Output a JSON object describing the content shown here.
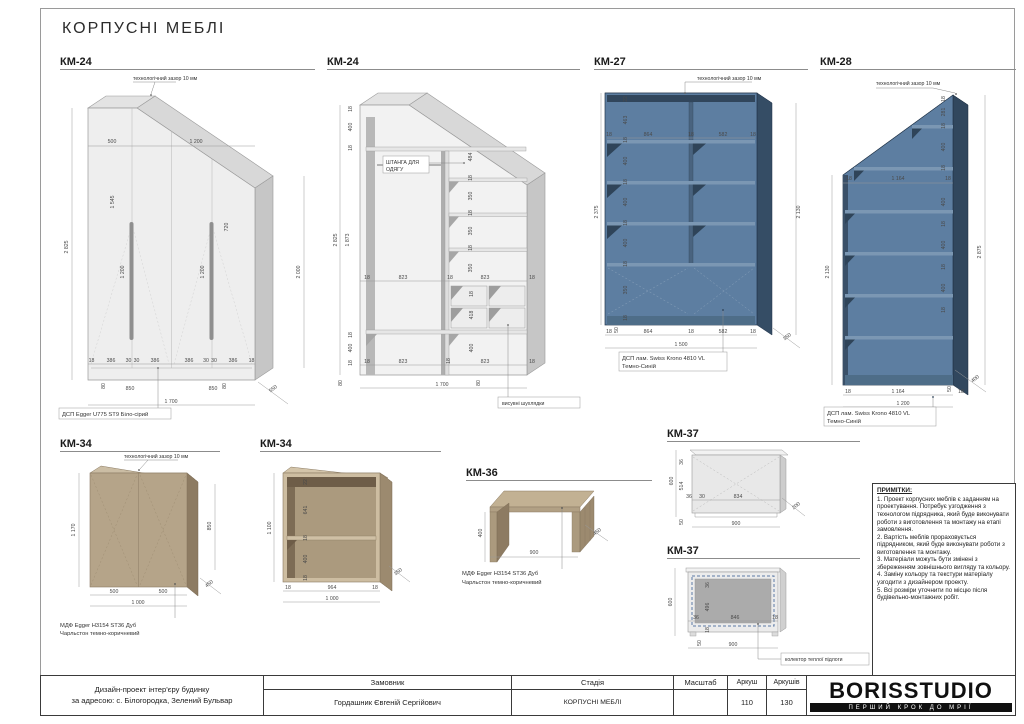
{
  "sheet": {
    "title": "КОРПУСНІ МЕБЛІ"
  },
  "drawings": {
    "km24a": {
      "code": "КМ-24",
      "leader_gap": "технологічний зазор 10 мм",
      "material": "ДСП Egger U775 ST9 Біло-сірий",
      "dims": [
        "500",
        "1 200",
        "1 545",
        "720",
        "2 825",
        "2 000",
        "1 200",
        "1 200",
        "18",
        "386",
        "30",
        "30",
        "386",
        "386",
        "30",
        "30",
        "386",
        "18",
        "80",
        "850",
        "850",
        "80",
        "1 700",
        "550"
      ]
    },
    "km24b": {
      "code": "КМ-24",
      "leader_rod_1": "ШТАНГА ДЛЯ",
      "leader_rod_2": "ОДЯГУ",
      "leader_drawers": "висувні шухлядки",
      "dims": [
        "18",
        "400",
        "18",
        "2 825",
        "1 873",
        "484",
        "18",
        "350",
        "18",
        "350",
        "18",
        "350",
        "18",
        "823",
        "18",
        "823",
        "18",
        "18",
        "418",
        "400",
        "18",
        "823",
        "18",
        "823",
        "18",
        "18",
        "400",
        "18",
        "80",
        "1 700",
        "80"
      ]
    },
    "km27": {
      "code": "КМ-27",
      "leader_gap": "технологічний зазор 10 мм",
      "material_1": "ДСП лам. Swiss Krono 4810 VL",
      "material_2": "Темно-Синій",
      "dims": [
        "2 375",
        "22",
        "463",
        "18",
        "400",
        "18",
        "400",
        "18",
        "400",
        "18",
        "350",
        "18",
        "2 130",
        "18",
        "864",
        "18",
        "582",
        "18",
        "18",
        "50",
        "864",
        "18",
        "582",
        "18",
        "1 500",
        "350"
      ]
    },
    "km28": {
      "code": "КМ-28",
      "leader_gap": "технологічний зазор 10 мм",
      "material_1": "ДСП лам. Swiss Krono 4810 VL",
      "material_2": "Темно-Синій",
      "dims": [
        "18",
        "281",
        "18",
        "400",
        "18",
        "18",
        "1 164",
        "18",
        "400",
        "18",
        "400",
        "18",
        "400",
        "18",
        "2 130",
        "2 875",
        "18",
        "1 164",
        "50",
        "18",
        "1 200",
        "400"
      ]
    },
    "km34a": {
      "code": "КМ-34",
      "leader_gap": "технологічний зазор 10 мм",
      "material_1": "МДФ Egger H3154 ST36 Дуб",
      "material_2": "Чарльстон темно-коричневий",
      "dims": [
        "1 170",
        "850",
        "450",
        "500",
        "500",
        "1 000"
      ]
    },
    "km34b": {
      "code": "КМ-34",
      "dims": [
        "1 100",
        "22",
        "641",
        "18",
        "400",
        "18",
        "18",
        "964",
        "18",
        "1 000",
        "350"
      ]
    },
    "km36": {
      "code": "КМ-36",
      "material_1": "МДФ Egger H3154 ST36 Дуб",
      "material_2": "Чарльстон темно-коричневий",
      "dims": [
        "400",
        "900",
        "450"
      ]
    },
    "km37a": {
      "code": "КМ-37",
      "dims": [
        "600",
        "36",
        "514",
        "50",
        "36",
        "30",
        "834",
        "900",
        "200"
      ]
    },
    "km37b": {
      "code": "КМ-37",
      "leader_collector": "колектор теплої підлоги",
      "dims": [
        "600",
        "36",
        "496",
        "36",
        "846",
        "18",
        "18",
        "50",
        "900"
      ]
    }
  },
  "notes": {
    "heading": "ПРИМІТКИ:",
    "items": [
      "1. Проект корпусних меблів є заданням на проектування. Потребує узгодження з технологом підрядника, який буде виконувати роботи з виготовлення та монтажу на етапі замовлення.",
      "2. Вартість меблів прораховується підрядником, який буде виконувати роботи з виготовлення та монтажу.",
      "3. Матеріали можуть бути змінені з збереженням зовнішнього вигляду та кольору.",
      "4. Заміну кольору та текстури матеріалу узгодити з дизайнером проекту.",
      "5. Всі розміри уточнити по місцю після будівельно-монтажних робіт."
    ]
  },
  "titleblock": {
    "project_line1": "Дизайн-проект інтер'єру будинку",
    "project_line2": "за адресою: с. Білогородка, Зелений Бульвар",
    "customer_label": "Замовник",
    "customer_name": "Гордашник Євгеній Сергійович",
    "stage_label": "Стадія",
    "stage_value": "КОРПУСНІ МЕБЛІ",
    "scale_label": "Масштаб",
    "scale_value": "",
    "sheet_label": "Аркуш",
    "sheet_value": "110",
    "sheets_label": "Аркушів",
    "sheets_value": "130",
    "brand": "BORISSTUDIO",
    "tagline": "ПЕРШИЙ КРОК ДО МРІЇ"
  }
}
